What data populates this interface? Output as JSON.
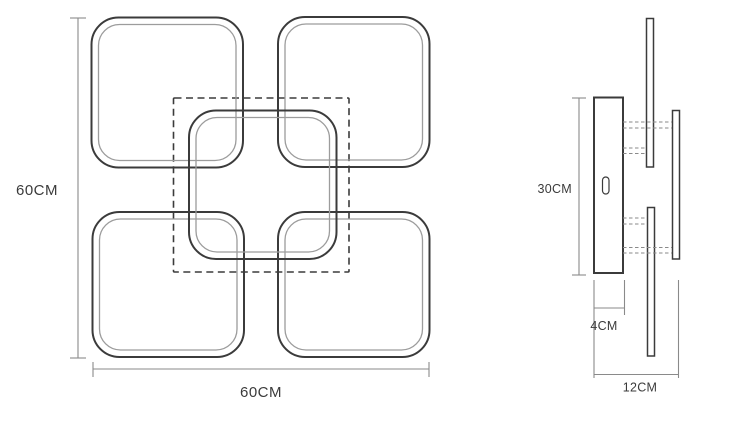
{
  "diagram_type": "ceiling-lamp-dimension-drawing",
  "colors": {
    "outline": "#3b3b3b",
    "inner_line": "#9c9c9c",
    "dimension_line": "#8a8a8a",
    "text": "#3b3b3b",
    "background": "#ffffff"
  },
  "top_view": {
    "height_label": "60CM",
    "width_label": "60CM"
  },
  "side_view": {
    "height_label": "30CM",
    "base_depth_label": "4CM",
    "total_depth_label": "12CM"
  }
}
